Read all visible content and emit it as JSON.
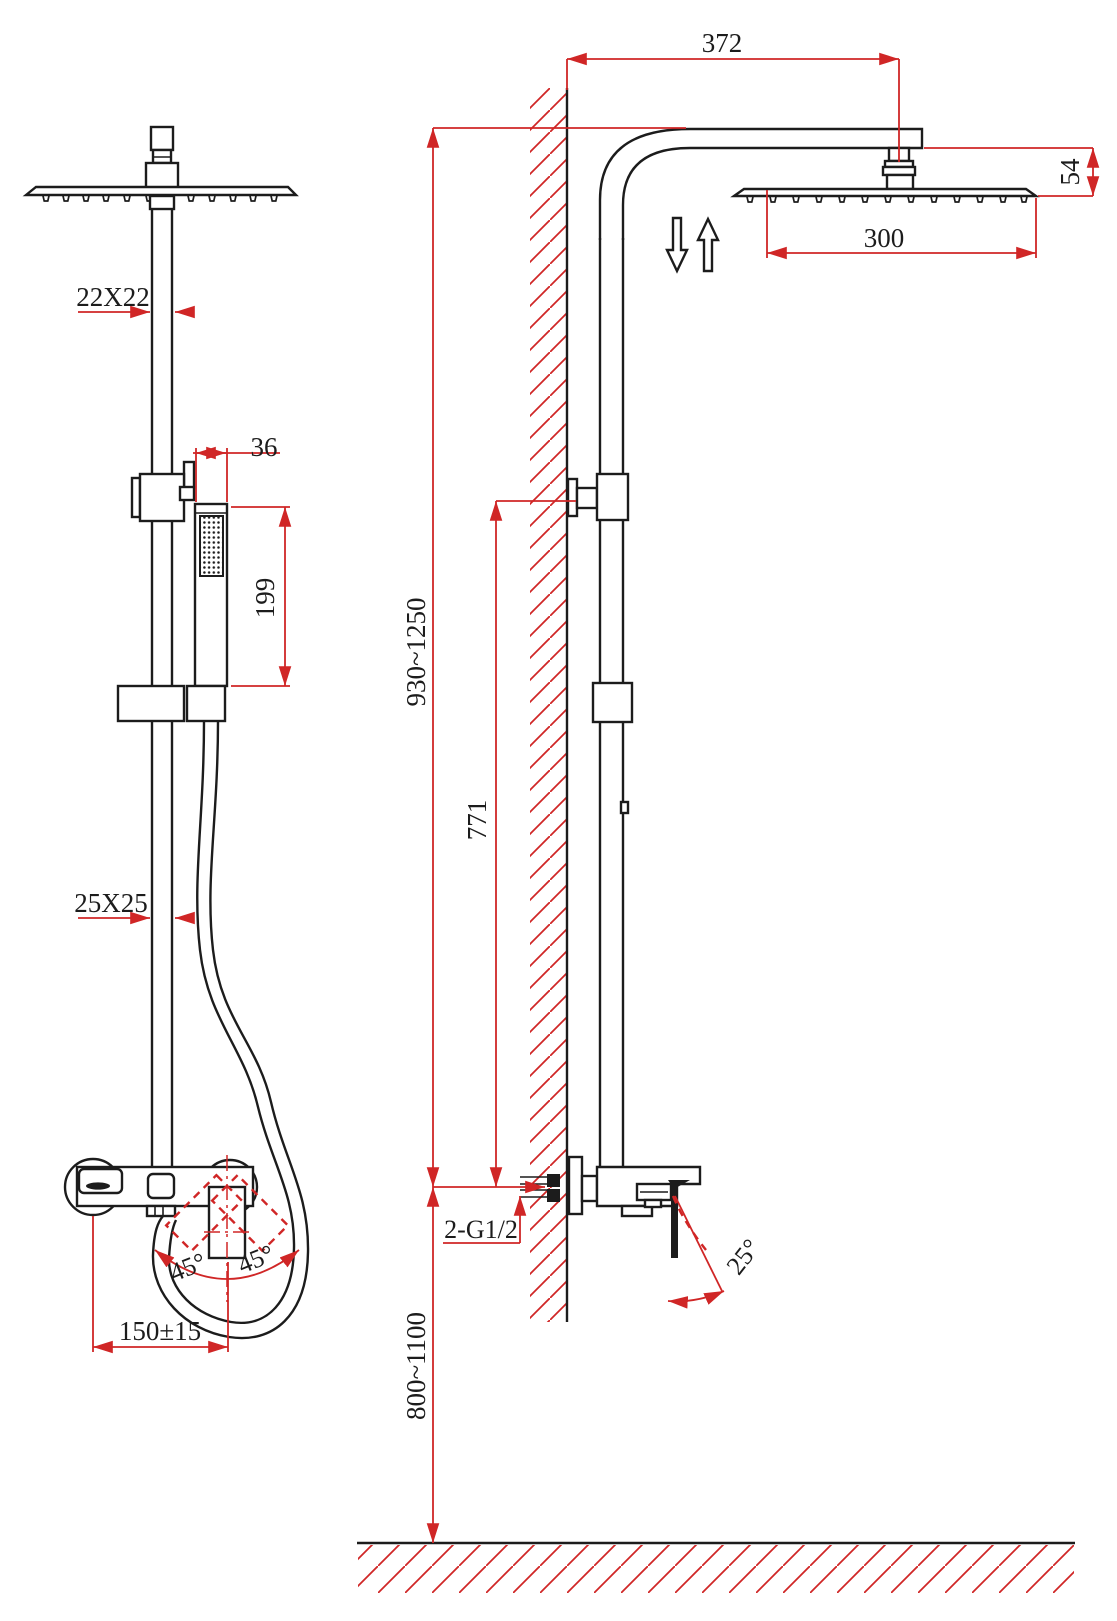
{
  "drawing": {
    "type": "technical-dimension-drawing",
    "subject": "wall-mounted shower column with rain head, hand shower and mixer — front and side installation views",
    "accent_color": "#d02626",
    "line_color": "#1c1c1c",
    "dims": {
      "arm_reach": "372",
      "head_drop": "54",
      "head_width": "300",
      "upper_pipe_section": "22X22",
      "hand_shower_width": "36",
      "hand_shower_length": "199",
      "riser_height_range": "930~1250",
      "bracket_height": "771",
      "lower_pipe_section": "25X25",
      "inlet_thread": "2-G1/2",
      "handle_tilt": "25°",
      "mixer_install_height": "800~1100",
      "swing_left": "45°",
      "swing_right": "45°",
      "inlet_center_distance": "150±15"
    }
  }
}
